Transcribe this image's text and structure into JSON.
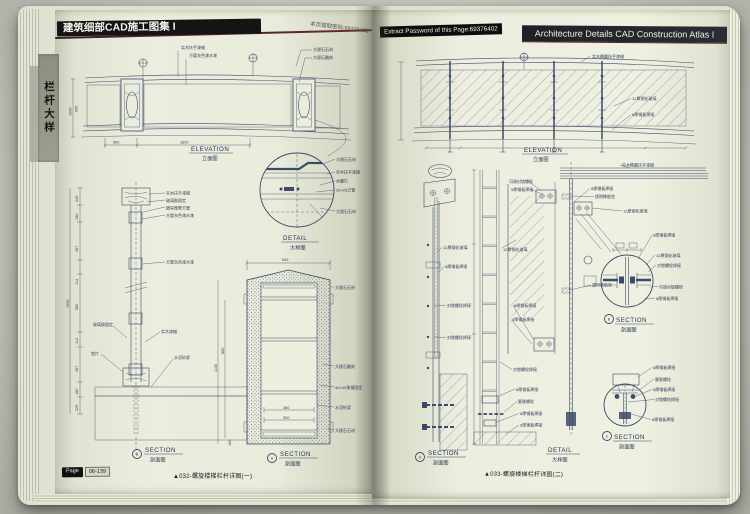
{
  "colors": {
    "ink": "#3c4a69",
    "page": "#eceede",
    "banner_black": "#141414",
    "rule_maroon": "#532228",
    "tab_gray": "#949688"
  },
  "left_page": {
    "header": "建筑细部CAD施工图集 I",
    "password_note": "本页提取密码:69376402",
    "side_tab": "栏杆大样",
    "elevation": {
      "title_en": "ELEVATION",
      "title_cn": "立面图",
      "labels": [
        "实木扶手漆蜡",
        "方管灰色漆水漆",
        "大理石石材",
        "大理石雕刻"
      ],
      "dims": [
        "500",
        "1620",
        "1000",
        "900"
      ]
    },
    "post_section": {
      "title_en": "SECTION",
      "title_cn": "剖面图",
      "bubble": "B",
      "labels": [
        "实木扶手漆蜡",
        "玻璃胶固定",
        "镀锌厚壁方管",
        "方管灰色漆水漆",
        "方管灰色漆水漆",
        "实木漆蜡",
        "玻璃胶固定",
        "垫片",
        "水泥砂浆"
      ],
      "dims": [
        "229",
        "160",
        "457",
        "114",
        "580",
        "114",
        "457",
        "160",
        "229",
        "1000"
      ]
    },
    "detail": {
      "title_en": "DETAIL",
      "title_cn": "大样图",
      "labels": [
        "大理石石材",
        "实木扶手漆蜡",
        "木螺钉",
        "25×25方管",
        "大理石石材"
      ]
    },
    "stone_section": {
      "title_en": "SECTION",
      "title_cn": "剖面图",
      "bubble": "A",
      "labels": [
        "大理石石材",
        "大理石雕刻",
        "40×40角钢固定",
        "水泥砂浆",
        "大理石石材"
      ],
      "dims": [
        "540",
        "360",
        "500",
        "1130",
        "800",
        "100"
      ]
    },
    "caption": "▲032-螺旋楼梯栏杆详图(一)",
    "page_badge": {
      "label": "Page",
      "number": "06-139"
    }
  },
  "right_page": {
    "password_label": "Extract Password of this Page:69376402",
    "header": "Architecture Details CAD Construction Atlas I",
    "elevation": {
      "title_en": "ELEVATION",
      "title_cn": "立面图",
      "labels": [
        "实木椭圆扶手漆蜡",
        "12厚钢化玻璃",
        "6厚钢板焊接"
      ]
    },
    "glass_section": {
      "title_en": "SECTION",
      "title_cn": "剖面图",
      "bubble": "A",
      "labels": [
        "12厚钢化玻璃",
        "6厚钢板焊接",
        "对锁螺栓焊接",
        "对锁螺栓焊接"
      ]
    },
    "center_detail": {
      "title_en": "DETAIL",
      "title_cn": "大样图",
      "labels": [
        "可调对锁螺栓",
        "5厚钢板焊接",
        "12厚钢化玻璃",
        "6厚钢板焊接",
        "5厚钢板焊接",
        "对锁螺栓焊接",
        "6厚钢板焊接",
        "膨胀螺栓",
        "6厚钢板焊接",
        "6厚钢板焊接"
      ]
    },
    "handrail_detail": {
      "labels": [
        "实木椭圆扶手漆蜡",
        "8厚钢板焊接",
        "透明橡胶垫",
        "12厚钢化玻璃",
        "透明橡胶垫"
      ]
    },
    "circle_b": {
      "title_en": "SECTION",
      "title_cn": "剖面图",
      "bubble": "B",
      "labels": [
        "8厚钢板焊接",
        "12厚钢化玻璃",
        "对锁螺栓焊接",
        "可调对锁螺栓",
        "8厚钢板焊接"
      ]
    },
    "circle_c": {
      "title_en": "SECTION",
      "title_cn": "剖面图",
      "bubble": "C",
      "labels": [
        "6厚钢板焊接",
        "膨胀螺栓",
        "6厚钢板焊接",
        "对锁螺栓焊接",
        "6厚钢板焊接"
      ]
    },
    "caption": "▲033-螺旋楼梯栏杆详图(二)"
  }
}
